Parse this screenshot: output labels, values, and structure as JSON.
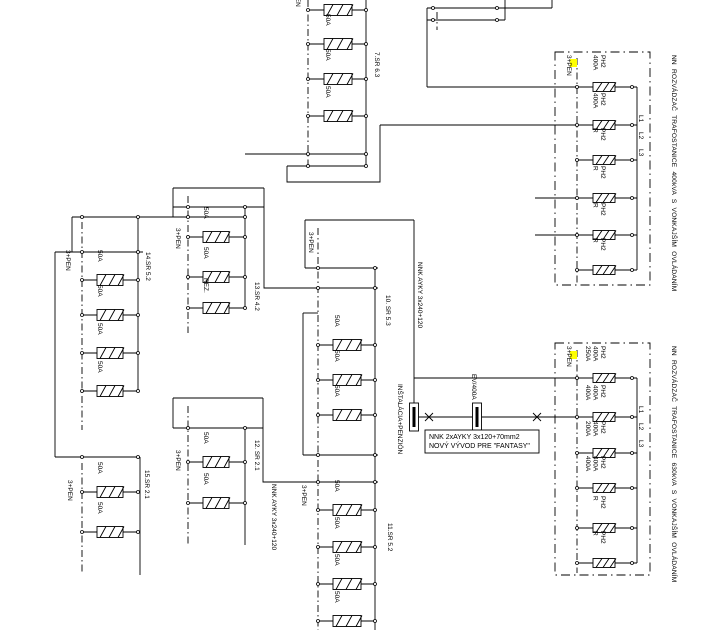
{
  "page": {
    "bg": "#ffffff",
    "ink": "#000000",
    "highlight": "#ffff00"
  },
  "diagram": {
    "groups": [
      {
        "id": "group-7sr",
        "label": "7.SR 6.3",
        "label_at": [
          375,
          52
        ],
        "pen_label": "3+PEN",
        "pen_label_at": [
          296,
          -14
        ],
        "pen": [
          308,
          0,
          166
        ],
        "coll": [
          366,
          0,
          166
        ],
        "bx": [
          308,
          366
        ],
        "fuse_cx": 338,
        "fuse_w": 28,
        "buses": [
          {
            "y": 154,
            "x0": 245,
            "x1": 366,
            "dots": [
              308,
              366
            ]
          },
          {
            "y": 166,
            "x0": 287,
            "x1": 366,
            "dots": [
              308,
              366
            ]
          }
        ],
        "fuses": [
          {
            "y": 10,
            "label": ""
          },
          {
            "y": 44,
            "label": "50A"
          },
          {
            "y": 79,
            "label": "50A"
          },
          {
            "y": 116,
            "label": "50A"
          }
        ]
      },
      {
        "id": "group-14sr",
        "label": "14.SR 5.2",
        "label_at": [
          146,
          252
        ],
        "pen_label": "3+PEN",
        "pen_label_at": [
          66,
          250
        ],
        "pen": [
          82,
          222,
          430
        ],
        "coll": [
          138,
          217,
          391
        ],
        "bx": [
          82,
          138
        ],
        "fuse_cx": 110,
        "fuse_w": 26,
        "buses": [
          {
            "y": 252,
            "x0": 55,
            "x1": 143,
            "dots": [
              82,
              138
            ]
          }
        ],
        "fuses": [
          {
            "y": 280,
            "label": "50A"
          },
          {
            "y": 315,
            "label": "50A"
          },
          {
            "y": 353,
            "label": "50A"
          },
          {
            "y": 391,
            "label": "50A"
          }
        ]
      },
      {
        "id": "group-15sr",
        "label": "15.SR 2.1",
        "label_at": [
          145,
          470
        ],
        "pen_label": "3+PEN",
        "pen_label_at": [
          68,
          480
        ],
        "pen": [
          82,
          463,
          572
        ],
        "coll": [
          140,
          457,
          575
        ],
        "bx": [
          82,
          138
        ],
        "fuse_cx": 110,
        "fuse_w": 26,
        "buses": [
          {
            "y": 457,
            "x0": 55,
            "x1": 140,
            "dots": [
              82,
              138
            ]
          }
        ],
        "fuses": [
          {
            "y": 492,
            "label": "50A"
          },
          {
            "y": 532,
            "label": "50A"
          }
        ]
      },
      {
        "id": "group-13sr",
        "label": "13.SR 4.2",
        "label_at": [
          255,
          282
        ],
        "pen_label": "3+PEN",
        "pen_label_at": [
          176,
          228
        ],
        "pen": [
          188,
          196,
          333
        ],
        "coll": [
          245,
          207,
          308
        ],
        "bx": [
          188,
          245
        ],
        "fuse_cx": 216,
        "fuse_w": 26,
        "buses": [
          {
            "y": 207,
            "x0": 173,
            "x1": 264,
            "dots": [
              188,
              245
            ]
          }
        ],
        "fuses": [
          {
            "y": 237,
            "label": "50A"
          },
          {
            "y": 277,
            "label": "50A"
          },
          {
            "y": 308,
            "label": "REZ."
          }
        ]
      },
      {
        "id": "group-12sr",
        "label": "12. SR 2.1",
        "label_at": [
          255,
          440
        ],
        "pen_label": "3+PEN",
        "pen_label_at": [
          176,
          450
        ],
        "pen": [
          188,
          406,
          545
        ],
        "coll": [
          245,
          428,
          545
        ],
        "bx": [
          188,
          245
        ],
        "fuse_cx": 216,
        "fuse_w": 26,
        "buses": [
          {
            "y": 428,
            "x0": 173,
            "x1": 263,
            "dots": [
              188,
              245
            ]
          }
        ],
        "fuses": [
          {
            "y": 462,
            "label": "50A"
          },
          {
            "y": 503,
            "label": "50A"
          }
        ]
      },
      {
        "id": "group-10sr",
        "label": "10. SR 5.3",
        "label_at": [
          386,
          295
        ],
        "pen_label": "3+PEN",
        "pen_label_at": [
          309,
          232
        ],
        "pen": [
          318,
          228,
          630
        ],
        "coll": [
          375,
          268,
          630
        ],
        "bx": [
          318,
          375
        ],
        "fuse_cx": 347,
        "fuse_w": 28,
        "buses": [
          {
            "y": 268,
            "x0": 305,
            "x1": 378,
            "dots": [
              318,
              375
            ]
          }
        ],
        "fuses": [
          {
            "y": 345,
            "label": "50A"
          },
          {
            "y": 380,
            "label": "50A"
          },
          {
            "y": 415,
            "label": "50A"
          }
        ]
      },
      {
        "id": "group-11sr",
        "label": "11.SR 5.2",
        "label_at": [
          388,
          523
        ],
        "pen_label": "3+PEN",
        "pen_label_at": [
          302,
          485
        ],
        "pen": null,
        "coll": null,
        "bx": [
          318,
          375
        ],
        "fuse_cx": 347,
        "fuse_w": 28,
        "buses": [
          {
            "y": 455,
            "x0": 303,
            "x1": 378,
            "dots": [
              318,
              375
            ]
          }
        ],
        "fuses": [
          {
            "y": 510,
            "label": "50A"
          },
          {
            "y": 547,
            "label": "50A"
          },
          {
            "y": 584,
            "label": "50A"
          },
          {
            "y": 621,
            "label": "50A"
          }
        ]
      }
    ],
    "switchboards": [
      {
        "id": "board-400kva",
        "title": "NN ROZVÁDZAČ TRAFOSTANICE 400kVA S VONKAJŠÍM OVLÁDANÍM",
        "title_at": [
          672,
          55
        ],
        "frame": [
          555,
          52,
          95,
          233
        ],
        "pen_x": 577,
        "pen_y": [
          58,
          283
        ],
        "coll": [
          637,
          87,
          270
        ],
        "pen_label": "3+PEN",
        "pen_label_at": [
          567,
          55
        ],
        "hl_at": [
          570,
          59
        ],
        "dot_left": 577,
        "dot_right": 632,
        "fuse_cx": 604,
        "branches": [
          {
            "y": 87,
            "x_left": 427,
            "label": [
              "PH2",
              "400A"
            ]
          },
          {
            "y": 125,
            "x_left": 380,
            "label": [
              "PH2",
              "400A"
            ]
          },
          {
            "y": 160,
            "x_left": 577,
            "label": [
              "PH2",
              "R"
            ]
          },
          {
            "y": 198,
            "x_left": 535,
            "label": [
              "PH2",
              "R"
            ]
          },
          {
            "y": 235,
            "x_left": 535,
            "label": [
              "PH2",
              "R"
            ]
          },
          {
            "y": 270,
            "x_left": 577,
            "label": [
              "PH2",
              "R"
            ]
          }
        ],
        "phases": {
          "items": [
            "L1",
            "L2",
            "L3"
          ],
          "x": 639,
          "y0": 115,
          "dy": 17
        }
      },
      {
        "id": "board-630kva",
        "title": "NN ROZVÁDZAČ TRAFOSTANICE 630kVA S VONKAJŠÍM OVLÁDANÍM",
        "title_at": [
          672,
          346
        ],
        "frame": [
          555,
          343,
          95,
          232
        ],
        "pen_x": 577,
        "pen_y": [
          350,
          573
        ],
        "coll": [
          637,
          378,
          563
        ],
        "pen_label": "3+PEN",
        "pen_label_at": [
          567,
          346
        ],
        "hl_at": [
          570,
          351
        ],
        "dot_left": 577,
        "dot_right": 632,
        "fuse_cx": 604,
        "branches": [
          {
            "y": 378,
            "x_left": 414,
            "label": [
              "PH2",
              "400A",
              "250A"
            ]
          },
          {
            "y": 417,
            "x_left": 409,
            "label": [
              "PH2",
              "400A",
              "400A"
            ]
          },
          {
            "y": 453,
            "x_left": 577,
            "label": [
              "PH2",
              "400A",
              "200A"
            ]
          },
          {
            "y": 488,
            "x_left": 577,
            "label": [
              "PH2",
              "400A",
              "400A"
            ]
          },
          {
            "y": 528,
            "x_left": 577,
            "label": [
              "PH2",
              "R"
            ]
          },
          {
            "y": 563,
            "x_left": 577,
            "label": [
              "PH2",
              "R"
            ]
          }
        ],
        "phases": {
          "items": [
            "L1",
            "L2",
            "L3"
          ],
          "x": 639,
          "y0": 406,
          "dy": 17
        }
      }
    ],
    "links": {
      "solid": [
        {
          "name": "bus-14sr-13sr",
          "pts": [
            [
              72,
              217
            ],
            [
              245,
              217
            ]
          ],
          "dots": [
            [
              82,
              217
            ],
            [
              138,
              217
            ],
            [
              188,
              217
            ],
            [
              245,
              217
            ]
          ]
        },
        {
          "name": "wire",
          "pts": [
            [
              72,
              217
            ],
            [
              72,
              252
            ]
          ]
        },
        {
          "name": "wire-14sr-to-15sr",
          "pts": [
            [
              55,
              252
            ],
            [
              55,
              457
            ]
          ]
        },
        {
          "name": "wire",
          "pts": [
            [
              173,
              188
            ],
            [
              264,
              188
            ]
          ]
        },
        {
          "name": "wire",
          "pts": [
            [
              173,
              188
            ],
            [
              173,
              217
            ]
          ]
        },
        {
          "name": "wire-13sr-to-10sr",
          "pts": [
            [
              264,
              188
            ],
            [
              264,
              288
            ],
            [
              378,
              288
            ]
          ],
          "dots": [
            [
              318,
              288
            ],
            [
              375,
              288
            ]
          ]
        },
        {
          "name": "wire",
          "pts": [
            [
              173,
              398
            ],
            [
              263,
              398
            ]
          ]
        },
        {
          "name": "wire",
          "pts": [
            [
              173,
              398
            ],
            [
              173,
              428
            ]
          ]
        },
        {
          "name": "wire-12sr-to-11sr",
          "pts": [
            [
              263,
              398
            ],
            [
              263,
              482
            ],
            [
              378,
              482
            ]
          ],
          "dots": [
            [
              318,
              482
            ],
            [
              375,
              482
            ]
          ]
        },
        {
          "name": "wire-7sr-to-400kva",
          "pts": [
            [
              287,
              166
            ],
            [
              287,
              182
            ],
            [
              380,
              182
            ],
            [
              380,
              125
            ]
          ]
        },
        {
          "name": "wire-top-feed",
          "pts": [
            [
              427,
              8
            ],
            [
              427,
              87
            ]
          ]
        },
        {
          "name": "wire-top-bus-1",
          "pts": [
            [
              427,
              8
            ],
            [
              552,
              8
            ]
          ],
          "dots": [
            [
              433,
              8
            ],
            [
              497,
              8
            ]
          ]
        },
        {
          "name": "wire-top-bus-2",
          "pts": [
            [
              427,
              20
            ],
            [
              505,
              20
            ]
          ],
          "dots": [
            [
              433,
              20
            ],
            [
              497,
              20
            ]
          ]
        },
        {
          "name": "wire",
          "pts": [
            [
              552,
              0
            ],
            [
              552,
              8
            ]
          ]
        },
        {
          "name": "wire",
          "pts": [
            [
              505,
              0
            ],
            [
              505,
              20
            ]
          ]
        },
        {
          "name": "wire-10sr-top",
          "pts": [
            [
              305,
              220
            ],
            [
              414,
              220
            ]
          ]
        },
        {
          "name": "cable-nnk-ayky-down",
          "pts": [
            [
              414,
              220
            ],
            [
              414,
              403
            ]
          ]
        },
        {
          "name": "wire",
          "pts": [
            [
              305,
              220
            ],
            [
              305,
              268
            ]
          ]
        },
        {
          "name": "wire",
          "pts": [
            [
              303,
              313
            ],
            [
              318,
              313
            ]
          ]
        },
        {
          "name": "wire-left-frame",
          "pts": [
            [
              303,
              313
            ],
            [
              303,
              455
            ]
          ]
        }
      ],
      "dashdot": [
        {
          "name": "pen-line-top",
          "pts": [
            [
              437,
              12
            ],
            [
              437,
              30
            ]
          ]
        }
      ]
    },
    "devices": [
      {
        "name": "cable-termination-instalacia",
        "cx": 414,
        "cy": 417
      },
      {
        "name": "cable-termination-ev",
        "cx": 477,
        "cy": 417
      }
    ],
    "xmarks": [
      [
        429,
        417
      ],
      [
        537,
        417
      ]
    ],
    "labels_rot": [
      {
        "name": "cable-label-nnk-ayky-1",
        "at": [
          418,
          262
        ],
        "text": "NNK AYKY 3x240+120"
      },
      {
        "name": "cable-label-nnk-ayky-2",
        "at": [
          272,
          484
        ],
        "text": "NNK AYKY 3x240+120"
      },
      {
        "name": "feeder-label-instalacia-penzion",
        "at": [
          398,
          384
        ],
        "text": "INŠTALÁCIA+PENZIÓN"
      },
      {
        "name": "device-label-ev-400a",
        "at": [
          472,
          374
        ],
        "text": "EV/400A"
      }
    ],
    "note": {
      "frame": [
        425,
        430,
        114,
        23
      ],
      "lines": [
        "NNK 2xAYKY 3x120+70mm2",
        "NOVÝ VÝVOD PRE \"FANTASY\""
      ],
      "at": [
        429,
        439
      ],
      "line_h": 9
    }
  }
}
